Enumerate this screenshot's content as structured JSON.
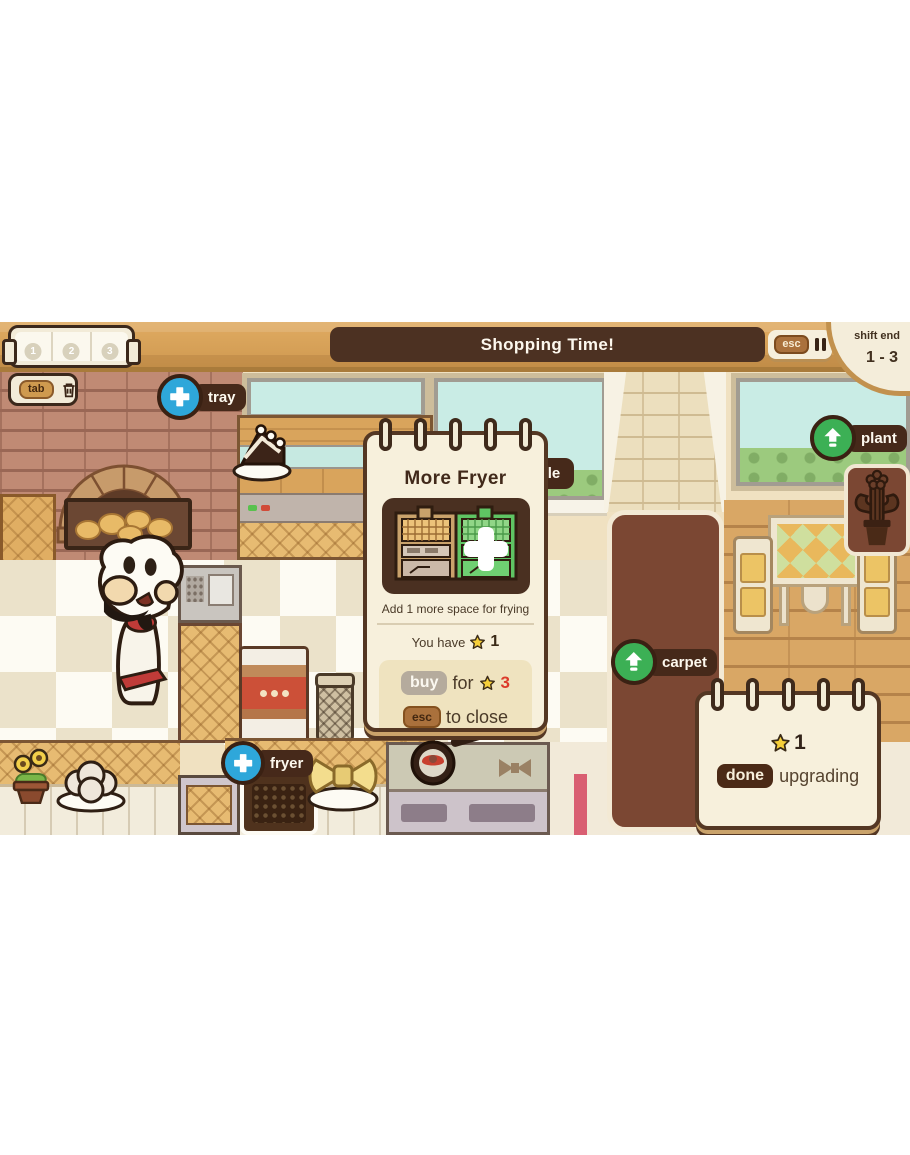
{
  "colors": {
    "accent_blue": "#2ea7da",
    "accent_green": "#3cb055",
    "star_yellow": "#f6cf3a",
    "cost_red": "#dc3b2a",
    "ui_dark_brown": "#4c3122",
    "panel_cream": "#f6efdc",
    "wood_tan": "#d7a158",
    "carpet_brown": "#7b4733"
  },
  "hud": {
    "banner": "Shopping Time!",
    "esc_label": "esc",
    "shift_end_label": "shift end",
    "shift_range": "1 - 3",
    "slots": [
      "1",
      "2",
      "3"
    ],
    "tab_label": "tab"
  },
  "shop_tags": {
    "tray": "tray",
    "fryer": "fryer",
    "plant": "plant",
    "carpet": "carpet",
    "partial_label": "le"
  },
  "popup": {
    "title": "More Fryer",
    "description": "Add 1 more space for frying",
    "you_have_label": "You have",
    "owned_stars": "1",
    "buy_label": "buy",
    "for_label": "for",
    "cost_stars": "3",
    "esc_label": "esc",
    "to_close_label": "to close"
  },
  "upgrade_note": {
    "stars": "1",
    "done_label": "done",
    "upgrading_label": "upgrading"
  }
}
